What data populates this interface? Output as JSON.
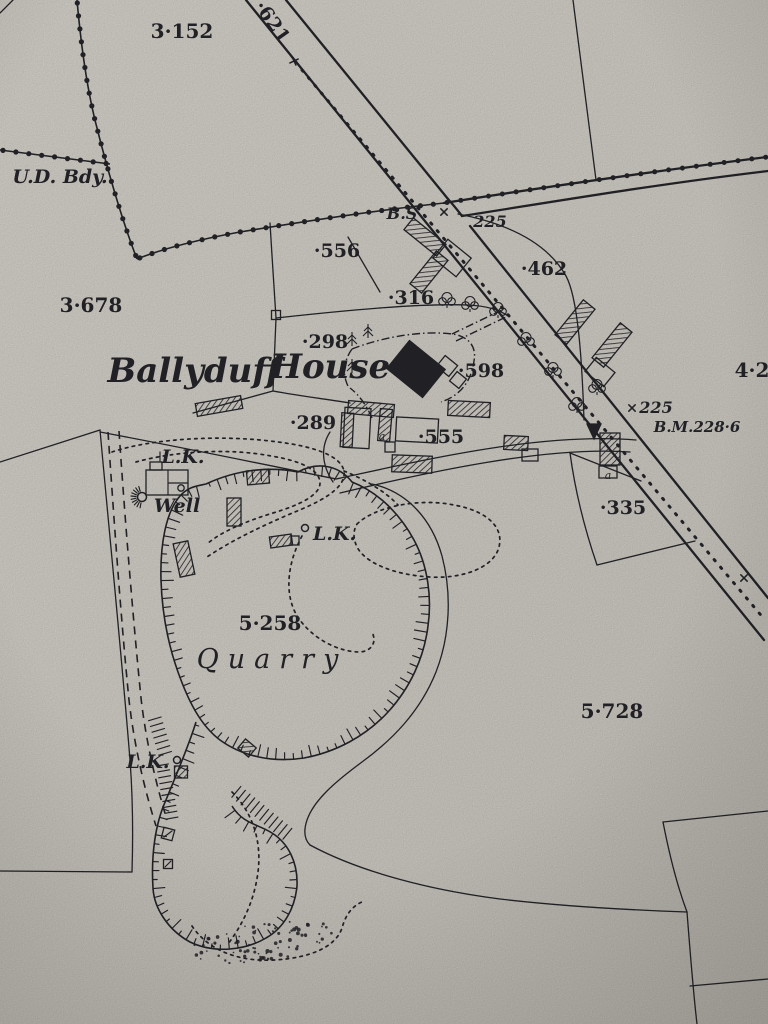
{
  "map": {
    "colors": {
      "paper": "#d6d2cb",
      "ink": "#26262b"
    },
    "labels": {
      "plot_3152": "3·152",
      "road_621": "·621",
      "ud_bdy": "U.D. Bdy.",
      "bs": "B.S",
      "level_225_junction": "225",
      "spot_556": "·556",
      "spot_462": "·462",
      "plot_3678": "3·678",
      "spot_316": "·316",
      "spot_298": "·298",
      "ballyduff": "Ballyduff",
      "house": "House",
      "spot_598": "·598",
      "plot_42": "4·2",
      "spot_289": "·289",
      "level_225_bm": "225",
      "benchmark": "B.M.228·6",
      "spot_555": "·555",
      "lk_well": "L.K.",
      "well": "Well",
      "lk_mid": "L.K.",
      "spot_335": "·335",
      "plot_5258": "5·258",
      "quarry": "Quarry",
      "plot_5728": "5·728",
      "lk_lower": "L.K.",
      "letter_a_1": "a",
      "letter_a_2": "a"
    }
  }
}
